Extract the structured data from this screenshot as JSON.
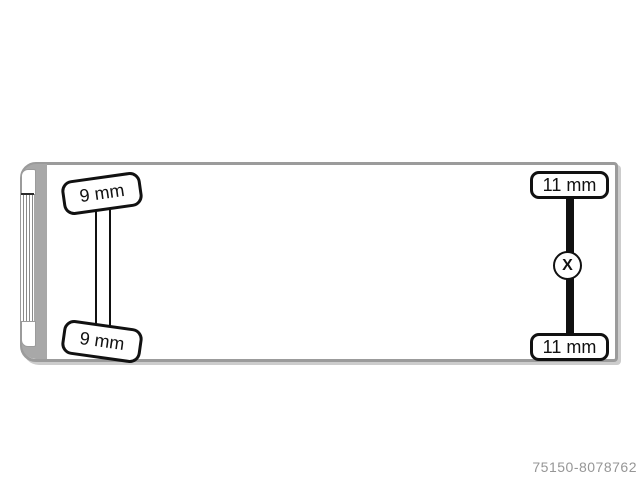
{
  "diagram": {
    "front_axle": {
      "top_tire_label": "9 mm",
      "bottom_tire_label": "9 mm"
    },
    "rear_axle": {
      "top_tire_label": "11 mm",
      "bottom_tire_label": "11 mm",
      "driven_marker": "X"
    },
    "footer_id": "75150-8078762",
    "colors": {
      "body_outline": "#9b9b9b",
      "cab_band": "#a8a8a8",
      "axle_black": "#111111",
      "footer_text": "#969696"
    }
  }
}
